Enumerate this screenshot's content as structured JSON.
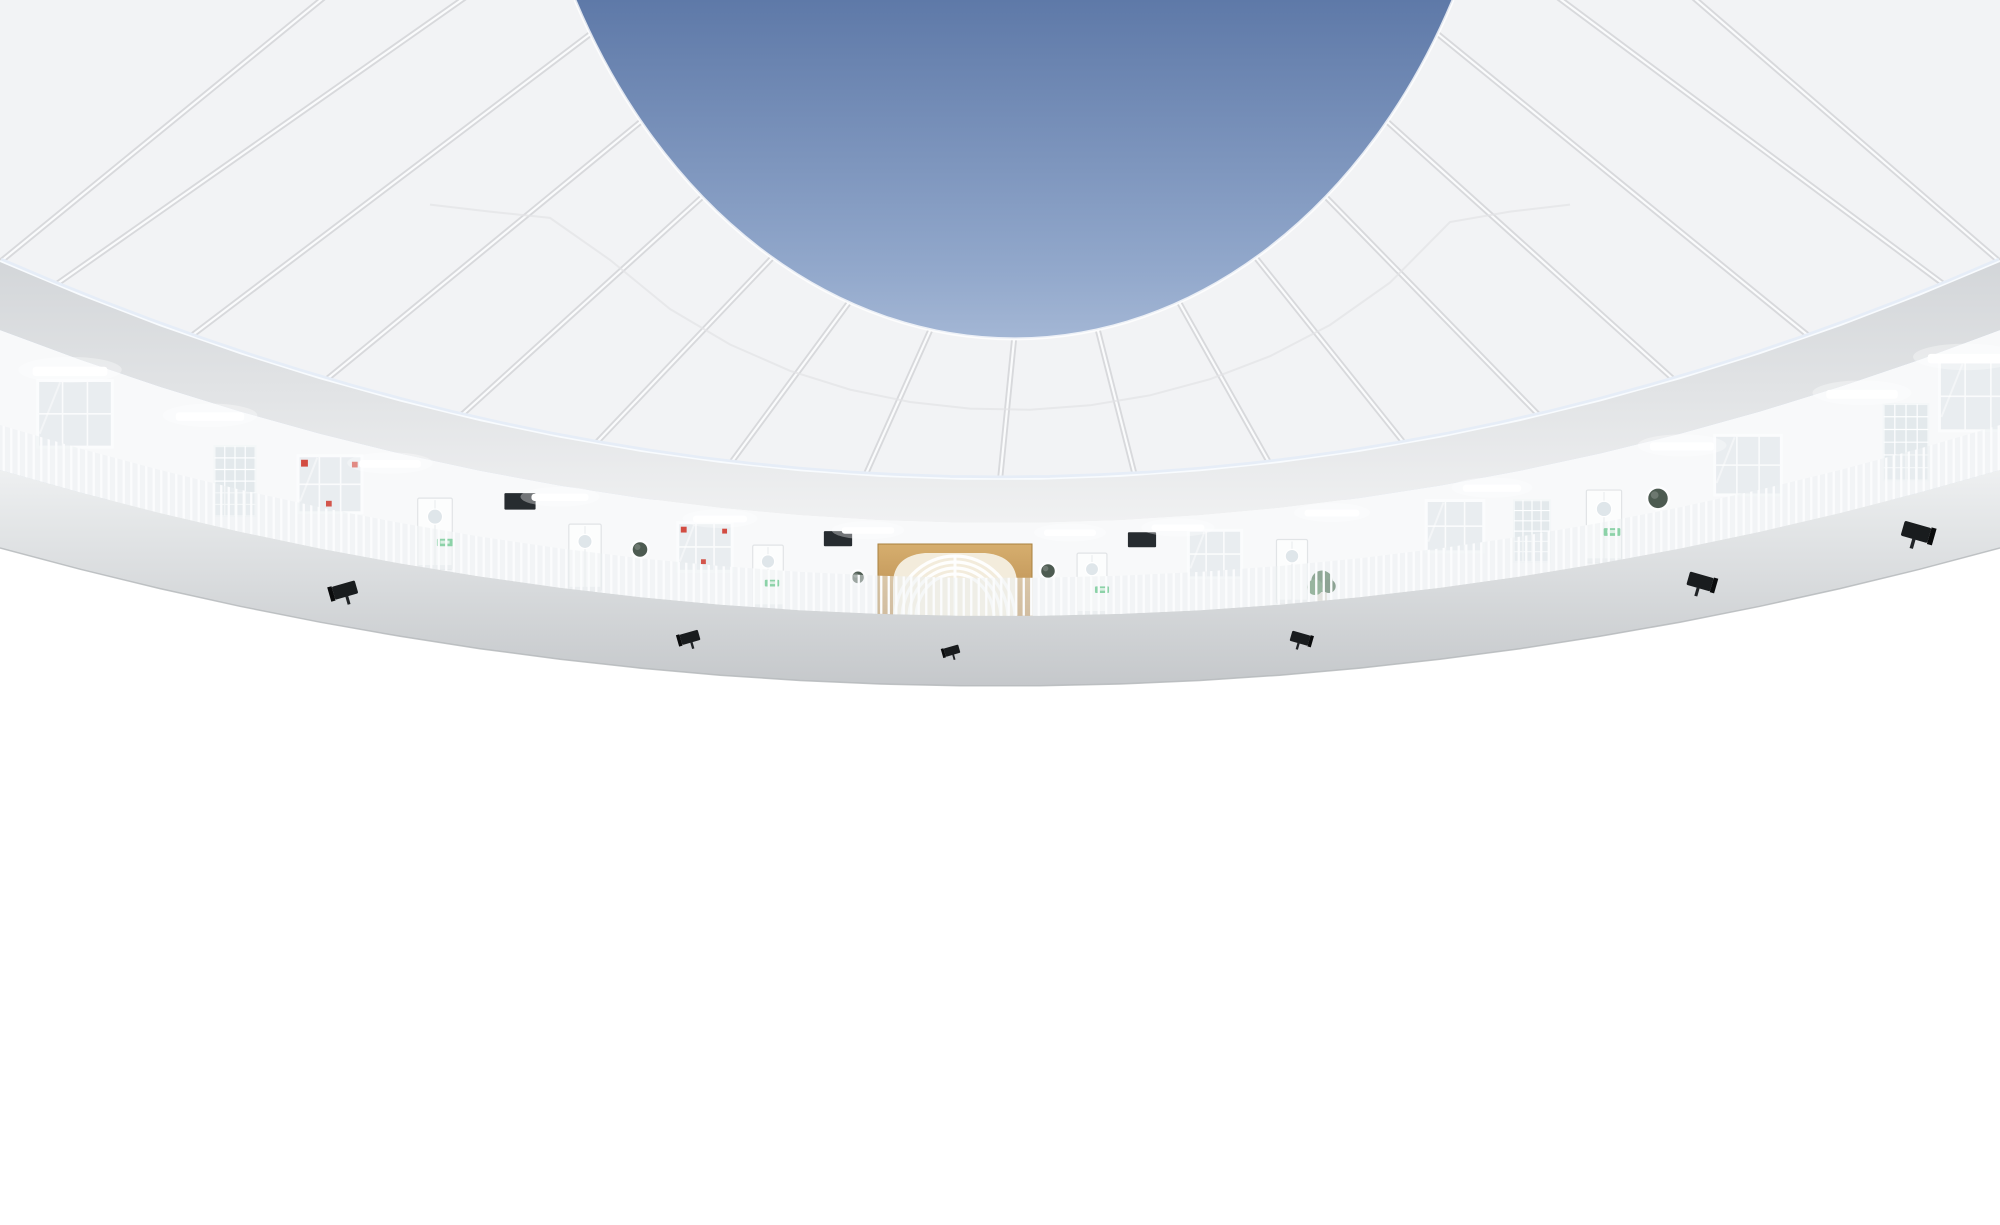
{
  "scene_name": "circular-kindergarten-atrium",
  "palette": {
    "sky_top": "#5e79a8",
    "sky_mid": "#93a9cc",
    "sky_bottom": "#cdd9eb",
    "canopy": "#f2f3f5",
    "canopy_rib": "#d8d9dc",
    "canopy_rib_hi": "#fafbfc",
    "rim_glow": "#e6edf7",
    "rim_glow_hi": "#f8fbfe",
    "dome_top": "#d3d6d9",
    "dome_bottom": "#f0f1f2",
    "wall": "#f8f9fa",
    "fascia_top": "#eef0f1",
    "fascia_bottom": "#c5c8cb",
    "fascia_edge": "#b3b6b9",
    "railing": "#fcfdfe",
    "baluster": "#fbfcfd",
    "wood_light": "#d6ae6e",
    "wood_dark": "#b6894e",
    "wood_edge": "#a9813f",
    "portal_cream": "#f3ecdc",
    "corridor": "#f1eee6",
    "corridor_back": "#faf8f3",
    "corridor_floor": "#e7e2d6",
    "runner": "#d9c7a0",
    "runner_line": "#c6b288",
    "porthole": "#4d5b51",
    "cork": "#c89858",
    "board": "#272c30",
    "exit_green": "#2db45e",
    "exit_light": "#d9f4e2",
    "flood_black": "#191c1e",
    "red": "#cf3a2e",
    "red_gold": "#ecc06a",
    "smooth_top": "#dadcdd",
    "smooth_bottom": "#c2c4c6",
    "mat": "#8b8e90",
    "curb": "#6e7173",
    "beige": "#dcd6c7",
    "stair_dark": "#43494d",
    "stair_mid": "#5b6266",
    "stair_tread": "#8f969a",
    "stair_door": "#30363a",
    "tile_green": "#3aa45b",
    "tile_blue": "#5b7fc4",
    "tile_pink": "#efa6b3",
    "tile_yellow": "#e5b42b",
    "tile_red": "#d84a41",
    "plant": "#35603d",
    "plant_hi": "#447a4c",
    "skin": "#caa08a",
    "hair": "#1c1c1e",
    "bag": "#17191a",
    "pants": "#2e3033",
    "glass_pane": "#e9edf0",
    "glassblock": "#e3e9ec",
    "photo_bg": "#f6f1e8",
    "bin_white": "#f3f4f3",
    "bin_toys": "#c89a5e",
    "bin_toys_dark": "#a5713c",
    "child_top": "#f2a8b8",
    "child_skirt": "#eec23f",
    "coat_red": "#d8352c"
  },
  "counts": {
    "gallery_levels": 4,
    "canopy_ribs": 17,
    "central_portals": 3,
    "stair_flights": 3
  },
  "floors": [
    {
      "id": "f3",
      "name": "third-floor-gallery",
      "hc": 93,
      "features": [
        {
          "t": "window",
          "x": 75
        },
        {
          "t": "glass",
          "x": 235
        },
        {
          "t": "window",
          "x": 330,
          "red": 1
        },
        {
          "t": "door",
          "x": 435
        },
        {
          "t": "board",
          "x": 520
        },
        {
          "t": "door",
          "x": 585
        },
        {
          "t": "porthole",
          "x": 640,
          "r": 8
        },
        {
          "t": "window",
          "x": 705,
          "red": 1
        },
        {
          "t": "door",
          "x": 768
        },
        {
          "t": "board",
          "x": 838
        },
        {
          "t": "porthole",
          "x": 858,
          "r": 7,
          "yf": 0.62
        },
        {
          "t": "cork",
          "x": 1008,
          "r": 11
        },
        {
          "t": "porthole",
          "x": 1048,
          "r": 8
        },
        {
          "t": "door",
          "x": 1092
        },
        {
          "t": "board",
          "x": 1142
        },
        {
          "t": "window",
          "x": 1215
        },
        {
          "t": "door",
          "x": 1292
        },
        {
          "t": "plant",
          "x": 1322
        },
        {
          "t": "window",
          "x": 1455
        },
        {
          "t": "glass",
          "x": 1532
        },
        {
          "t": "door",
          "x": 1604
        },
        {
          "t": "porthole",
          "x": 1658,
          "r": 9
        },
        {
          "t": "window",
          "x": 1748
        },
        {
          "t": "glass",
          "x": 1906
        },
        {
          "t": "window",
          "x": 1978
        }
      ],
      "exits": [
        445,
        772,
        1102,
        1612
      ],
      "lights": [
        70,
        210,
        390,
        560,
        720,
        868,
        1070,
        1178,
        1332,
        1492,
        1682,
        1862,
        1966
      ],
      "floods": [
        345,
        690,
        952,
        1300,
        1700,
        1916
      ]
    },
    {
      "id": "f2",
      "name": "second-floor-gallery",
      "hc": 66,
      "features": [
        {
          "t": "door",
          "x": 60
        },
        {
          "t": "glass",
          "x": 170
        },
        {
          "t": "door",
          "x": 256
        },
        {
          "t": "porthole",
          "x": 358,
          "r": 9
        },
        {
          "t": "porthole",
          "x": 396,
          "r": 7,
          "yf": 0.66
        },
        {
          "t": "window",
          "x": 470
        },
        {
          "t": "door",
          "x": 562
        },
        {
          "t": "board",
          "x": 640
        },
        {
          "t": "cork",
          "x": 712,
          "r": 15
        },
        {
          "t": "door",
          "x": 778
        },
        {
          "t": "porthole",
          "x": 853,
          "r": 9
        },
        {
          "t": "porthole",
          "x": 1047,
          "r": 9
        },
        {
          "t": "porthole",
          "x": 1079,
          "r": 7,
          "yf": 0.68
        },
        {
          "t": "door",
          "x": 1130
        },
        {
          "t": "window",
          "x": 1212
        },
        {
          "t": "board",
          "x": 1290
        },
        {
          "t": "window",
          "x": 1382
        },
        {
          "t": "door",
          "x": 1452
        },
        {
          "t": "cork",
          "x": 1546,
          "r": 13
        },
        {
          "t": "glass",
          "x": 1642
        },
        {
          "t": "door",
          "x": 1742
        },
        {
          "t": "window",
          "x": 1852
        },
        {
          "t": "door",
          "x": 1952
        }
      ],
      "exits": [
        266,
        572,
        1142,
        1458,
        1752
      ],
      "lights": [
        100,
        262,
        432,
        612,
        778,
        1062,
        1182,
        1342,
        1502,
        1702,
        1882
      ],
      "floods": [
        300,
        682,
        1024,
        1352,
        1762
      ]
    },
    {
      "id": "f1",
      "name": "first-floor-gallery",
      "hc": 80,
      "features": [
        {
          "t": "photos",
          "x": 62
        },
        {
          "t": "redboard",
          "x": 132
        },
        {
          "t": "glass",
          "x": 232
        },
        {
          "t": "banner",
          "x": 302
        },
        {
          "t": "cork",
          "x": 358,
          "r": 13
        },
        {
          "t": "door",
          "x": 422,
          "red": 1
        },
        {
          "t": "window",
          "x": 502,
          "red": 1
        },
        {
          "t": "banner",
          "x": 562
        },
        {
          "t": "door",
          "x": 622,
          "red": 1
        },
        {
          "t": "porthole",
          "x": 682,
          "r": 10
        },
        {
          "t": "photos",
          "x": 738
        },
        {
          "t": "window",
          "x": 792,
          "red": 1
        },
        {
          "t": "porthole",
          "x": 850,
          "r": 9,
          "yf": 0.6
        },
        {
          "t": "porthole",
          "x": 1040,
          "r": 10
        },
        {
          "t": "door",
          "x": 1092
        },
        {
          "t": "photos",
          "x": 1148
        },
        {
          "t": "window",
          "x": 1222
        },
        {
          "t": "porthole",
          "x": 1270,
          "r": 8,
          "yf": 0.62
        },
        {
          "t": "door",
          "x": 1322
        },
        {
          "t": "glass",
          "x": 1638
        },
        {
          "t": "window",
          "x": 1706
        },
        {
          "t": "door",
          "x": 1786
        },
        {
          "t": "window",
          "x": 1886
        },
        {
          "t": "door",
          "x": 1962
        }
      ],
      "exits": [
        432,
        632,
        1096,
        1326
      ],
      "lights": [
        142,
        302,
        472,
        642,
        806,
        1082,
        1242,
        1422,
        1622,
        1822,
        1962
      ],
      "floods": [
        256,
        612,
        1292,
        1662
      ]
    },
    {
      "id": "g",
      "name": "ground-floor",
      "hc": 42,
      "features": [
        {
          "t": "glass",
          "x": 452
        },
        {
          "t": "window",
          "x": 522
        },
        {
          "t": "redboard",
          "x": 588
        },
        {
          "t": "door",
          "x": 642,
          "hf": 1.0
        },
        {
          "t": "porthole",
          "x": 702,
          "r": 10
        },
        {
          "t": "door",
          "x": 782,
          "hf": 1.0
        },
        {
          "t": "porthole",
          "x": 840,
          "r": 13,
          "yf": 0.55
        },
        {
          "t": "porthole",
          "x": 868,
          "r": 9,
          "yf": 0.8
        },
        {
          "t": "porthole",
          "x": 1036,
          "r": 12,
          "yf": 0.55
        },
        {
          "t": "porthole",
          "x": 1064,
          "r": 8,
          "yf": 0.8
        },
        {
          "t": "door",
          "x": 1108,
          "hf": 1.0
        },
        {
          "t": "photos",
          "x": 1162
        },
        {
          "t": "window",
          "x": 1232
        },
        {
          "t": "door",
          "x": 1302,
          "hf": 1.0
        }
      ],
      "exits": [
        648,
        1114
      ],
      "lights": [
        532,
        1152
      ],
      "floods": []
    }
  ],
  "side_walls": {
    "left": [
      {
        "t": "redboard",
        "x": 8,
        "y": 898,
        "w": 44,
        "h": 100
      },
      {
        "t": "door",
        "x": 86,
        "y": 850,
        "w": 64,
        "h": 152
      },
      {
        "t": "photos",
        "x": 168,
        "y": 878,
        "w": 58,
        "h": 100
      },
      {
        "t": "glass",
        "x": 240,
        "y": 888,
        "w": 44,
        "h": 118
      },
      {
        "t": "exit",
        "x": 118,
        "y": 826,
        "w": 16,
        "h": 8
      }
    ],
    "right": [
      {
        "t": "window",
        "x": 1632,
        "y": 788,
        "w": 128,
        "h": 100
      },
      {
        "t": "glass",
        "x": 1626,
        "y": 898,
        "w": 38,
        "h": 100
      },
      {
        "t": "corkoval",
        "x": 1796,
        "y": 896,
        "w": 78,
        "h": 58
      },
      {
        "t": "door",
        "x": 1896,
        "y": 842,
        "w": 94,
        "h": 188,
        "oval": 1
      },
      {
        "t": "exit",
        "x": 1758,
        "y": 996,
        "w": 18,
        "h": 9
      },
      {
        "t": "porthole",
        "x": 1974,
        "y": 932,
        "r": 20
      }
    ]
  },
  "hopscotch": {
    "numbers": [
      1,
      2,
      3,
      4,
      5,
      6,
      7
    ],
    "blocks": [
      {
        "x": 486,
        "y": 1070,
        "w": 56,
        "h": 50,
        "c": "g",
        "digit": "1",
        "dc": "y"
      },
      {
        "x": 540,
        "y": 1094,
        "w": 62,
        "h": 46,
        "c": "y",
        "digit": "2",
        "dc": "r"
      },
      {
        "x": 564,
        "y": 1060,
        "w": 72,
        "h": 34,
        "c": "r",
        "digit": "3",
        "dc": "g"
      },
      {
        "x": 676,
        "y": 1094,
        "w": 92,
        "h": 44,
        "c": "r",
        "digit": "5",
        "dc": "y"
      },
      {
        "x": 702,
        "y": 1060,
        "w": 76,
        "h": 34,
        "c": "y",
        "digit": "6",
        "dc": "g"
      },
      {
        "x": 770,
        "y": 1074,
        "w": 84,
        "h": 40,
        "c": "g",
        "digit": "7",
        "dc": "b"
      }
    ],
    "path4": [
      {
        "x": 634,
        "y": 1078,
        "w": 64,
        "h": 17,
        "c": "b"
      },
      {
        "x": 648,
        "y": 1095,
        "w": 50,
        "h": 17,
        "c": "b"
      }
    ],
    "flowers": [
      {
        "x": 700,
        "y": 1030,
        "w": 22,
        "h": 15,
        "c": "p"
      },
      {
        "x": 744,
        "y": 1026,
        "w": 22,
        "h": 15,
        "c": "p"
      },
      {
        "x": 786,
        "y": 1028,
        "w": 36,
        "h": 28,
        "c": "p"
      },
      {
        "x": 722,
        "y": 1042,
        "w": 22,
        "h": 15,
        "c": "y"
      },
      {
        "x": 766,
        "y": 1040,
        "w": 22,
        "h": 15,
        "c": "y"
      },
      {
        "x": 700,
        "y": 1046,
        "w": 22,
        "h": 15,
        "c": "b"
      },
      {
        "x": 744,
        "y": 1044,
        "w": 34,
        "h": 15,
        "c": "b"
      },
      {
        "x": 812,
        "y": 1044,
        "w": 22,
        "h": 15,
        "c": "p"
      },
      {
        "x": 640,
        "y": 1146,
        "w": 36,
        "h": 28,
        "c": "b"
      },
      {
        "x": 676,
        "y": 1158,
        "w": 22,
        "h": 15,
        "c": "y"
      },
      {
        "x": 612,
        "y": 1162,
        "w": 22,
        "h": 15,
        "c": "p"
      },
      {
        "x": 698,
        "y": 1168,
        "w": 36,
        "h": 26,
        "c": "p"
      },
      {
        "x": 750,
        "y": 1150,
        "w": 36,
        "h": 26,
        "c": "y"
      },
      {
        "x": 788,
        "y": 1168,
        "w": 22,
        "h": 15,
        "c": "p"
      },
      {
        "x": 728,
        "y": 1146,
        "w": 22,
        "h": 15,
        "c": "b"
      },
      {
        "x": 660,
        "y": 1180,
        "w": 22,
        "h": 15,
        "c": "y"
      }
    ]
  },
  "mosaic": [
    [
      988,
      1006,
      46,
      30,
      "p"
    ],
    [
      988,
      1038,
      24,
      16,
      "p"
    ],
    [
      1042,
      1010,
      22,
      15,
      "p"
    ],
    [
      1082,
      1004,
      22,
      15,
      "p"
    ],
    [
      1124,
      1008,
      22,
      15,
      "p"
    ],
    [
      1060,
      1030,
      22,
      15,
      "p"
    ],
    [
      1008,
      1062,
      22,
      15,
      "p"
    ],
    [
      1046,
      1078,
      22,
      15,
      "p"
    ],
    [
      1158,
      1004,
      48,
      30,
      "y"
    ],
    [
      1130,
      1030,
      22,
      15,
      "y"
    ],
    [
      1200,
      1036,
      22,
      15,
      "y"
    ],
    [
      1094,
      1050,
      22,
      15,
      "y"
    ],
    [
      1220,
      1062,
      22,
      15,
      "y"
    ],
    [
      1046,
      1106,
      22,
      15,
      "y"
    ],
    [
      1346,
      1084,
      22,
      15,
      "y"
    ],
    [
      1064,
      1002,
      22,
      15,
      "b"
    ],
    [
      1142,
      1052,
      22,
      15,
      "b"
    ],
    [
      1216,
      1008,
      22,
      15,
      "b"
    ],
    [
      1250,
      1106,
      22,
      15,
      "b"
    ],
    [
      1274,
      1128,
      22,
      15,
      "b"
    ],
    [
      1298,
      1150,
      22,
      15,
      "b"
    ],
    [
      1320,
      1174,
      22,
      15,
      "b"
    ],
    [
      1010,
      1026,
      22,
      15,
      "g"
    ],
    [
      1236,
      1028,
      22,
      15,
      "g"
    ],
    [
      1196,
      1080,
      22,
      15,
      "g"
    ],
    [
      1240,
      1086,
      22,
      15,
      "g"
    ],
    [
      1286,
      1092,
      22,
      15,
      "g"
    ],
    [
      1330,
      1098,
      22,
      15,
      "g"
    ],
    [
      1376,
      1106,
      22,
      15,
      "g"
    ],
    [
      1104,
      1066,
      36,
      28,
      "p"
    ],
    [
      1140,
      1066,
      36,
      28,
      "y"
    ],
    [
      1104,
      1094,
      36,
      28,
      "b"
    ],
    [
      1140,
      1094,
      36,
      28,
      "g"
    ],
    [
      1090,
      1120,
      22,
      15,
      "p"
    ],
    [
      1184,
      1146,
      22,
      15,
      "p"
    ],
    [
      1240,
      1060,
      22,
      15,
      "p"
    ],
    [
      1108,
      1180,
      22,
      15,
      "p"
    ],
    [
      1194,
      1166,
      22,
      15,
      "p"
    ],
    [
      1420,
      1146,
      22,
      15,
      "p"
    ],
    [
      1020,
      1134,
      46,
      30,
      "b"
    ],
    [
      1058,
      1170,
      46,
      30,
      "b"
    ],
    [
      1006,
      1186,
      24,
      16,
      "b"
    ],
    [
      1264,
      1166,
      46,
      28,
      "g"
    ],
    [
      1332,
      1152,
      46,
      28,
      "g"
    ],
    [
      1360,
      1130,
      22,
      15,
      "g"
    ],
    [
      1148,
      1176,
      36,
      24,
      "y"
    ],
    [
      1398,
      1126,
      22,
      15,
      "y"
    ],
    [
      1216,
      1184,
      22,
      15,
      "y"
    ]
  ],
  "people": [
    {
      "id": "adult-in-red-coat",
      "x": 912,
      "feet_y": 912,
      "height": 44
    },
    {
      "id": "child",
      "x": 947,
      "feet_y": 908,
      "height": 26
    }
  ],
  "objects": {
    "cabinet": {
      "x": 926,
      "y": 890,
      "w": 46,
      "h": 28
    },
    "bins_near": [
      {
        "x": 1084,
        "y": 904,
        "w": 26,
        "h": 20
      },
      {
        "x": 1112,
        "y": 908,
        "w": 26,
        "h": 20
      },
      {
        "x": 1140,
        "y": 912,
        "w": 26,
        "h": 20
      }
    ],
    "bins_far": [
      {
        "x": 1312,
        "y": 948,
        "w": 36,
        "h": 26
      },
      {
        "x": 1352,
        "y": 954,
        "w": 36,
        "h": 26
      },
      {
        "x": 1394,
        "y": 960,
        "w": 36,
        "h": 26
      },
      {
        "x": 1436,
        "y": 966,
        "w": 34,
        "h": 26
      }
    ],
    "storage_box": {
      "x": 218,
      "y": 1192,
      "w": 92,
      "h": 34
    }
  }
}
